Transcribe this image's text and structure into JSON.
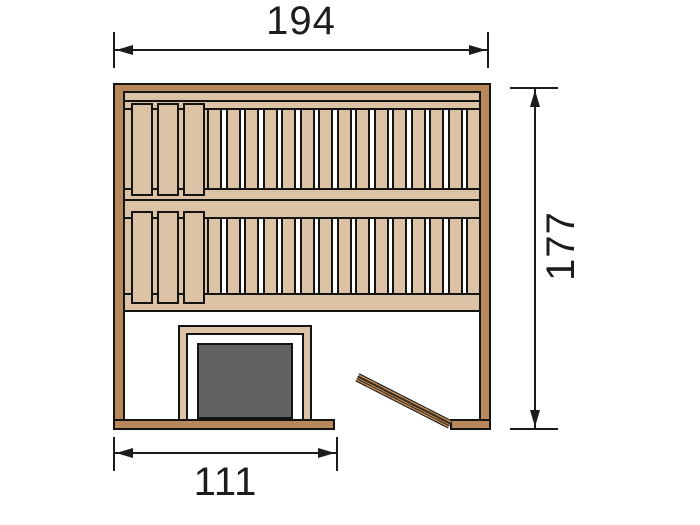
{
  "diagram": {
    "title": "sauna-floor-plan-top-view",
    "dimensions": {
      "width_label": "194",
      "depth_label": "177",
      "front_wall_label": "111"
    },
    "colors": {
      "wall_wood": "#b8885a",
      "bench_wood": "#dcc3a6",
      "heater_gray": "#636163",
      "outline": "#141414",
      "background": "#ffffff",
      "gap_white": "#ffffff",
      "door_stripe": "#3a2b1c",
      "dimension_line": "#1c1c1c"
    },
    "benches": {
      "rows": 2,
      "narrow_slats_per_row": 15,
      "wide_slats_per_row": 3
    }
  }
}
